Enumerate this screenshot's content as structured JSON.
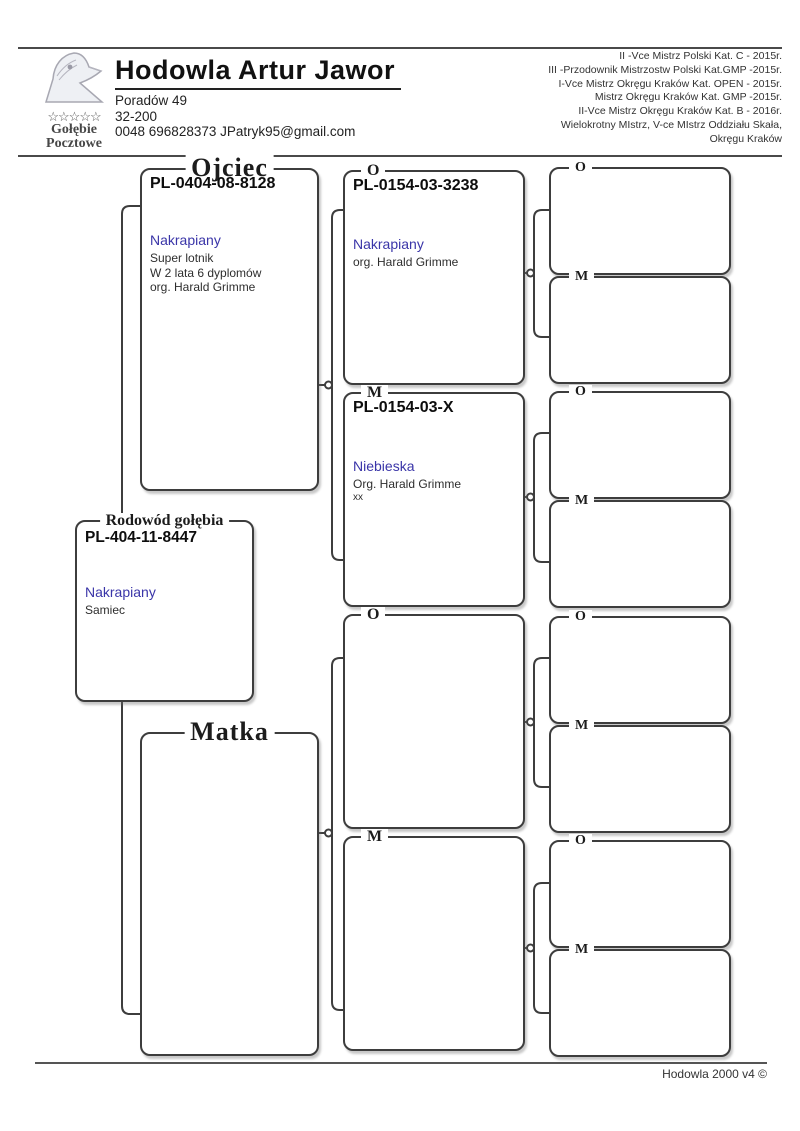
{
  "header": {
    "logo": {
      "stars": "☆☆☆☆☆",
      "line1": "Gołębie",
      "line2": "Pocztowe"
    },
    "title": "Hodowla Artur Jawor",
    "address_lines": [
      "Poradów 49",
      "32-200",
      "0048 696828373 JPatryk95@gmail.com"
    ],
    "achievements": [
      "II -Vce Mistrz Polski Kat. C - 2015r.",
      "III -Przodownik Mistrzostw Polski Kat.GMP -2015r.",
      "I-Vce Mistrz Okręgu Kraków Kat. OPEN - 2015r.",
      "Mistrz Okręgu Kraków Kat. GMP -2015r.",
      "II-Vce Mistrz Okręgu Kraków Kat. B - 2016r.",
      "Wielokrotny MIstrz, V-ce MIstrz  Oddziału Skała,",
      "Okręgu Kraków"
    ]
  },
  "pedigree": {
    "subject": {
      "label": "Rodowód gołębia",
      "ring": "PL-404-11-8447",
      "color_name": "Nakrapiany",
      "details": [
        "Samiec"
      ]
    },
    "father": {
      "label": "Ojciec",
      "ring": "PL-0404-08-8128",
      "color_name": "Nakrapiany",
      "details": [
        "Super lotnik",
        "W 2 lata 6 dyplomów",
        "org. Harald Grimme"
      ]
    },
    "mother": {
      "label": "Matka",
      "ring": "",
      "color_name": "",
      "details": []
    },
    "gen3": [
      {
        "label": "O",
        "ring": "PL-0154-03-3238",
        "color_name": "Nakrapiany",
        "details": [
          "org. Harald Grimme"
        ]
      },
      {
        "label": "M",
        "ring": "PL-0154-03-X",
        "color_name": "Niebieska",
        "details": [
          "Org. Harald Grimme",
          "xx"
        ]
      },
      {
        "label": "O",
        "ring": "",
        "color_name": "",
        "details": []
      },
      {
        "label": "M",
        "ring": "",
        "color_name": "",
        "details": []
      }
    ],
    "gen4": [
      {
        "label": "O"
      },
      {
        "label": "M"
      },
      {
        "label": "O"
      },
      {
        "label": "M"
      },
      {
        "label": "O"
      },
      {
        "label": "M"
      },
      {
        "label": "O"
      },
      {
        "label": "M"
      }
    ]
  },
  "footer": {
    "text": "Hodowla 2000 v4 ©"
  },
  "colors": {
    "accent_blue": "#3a35a8",
    "line": "#3d3d3d"
  }
}
